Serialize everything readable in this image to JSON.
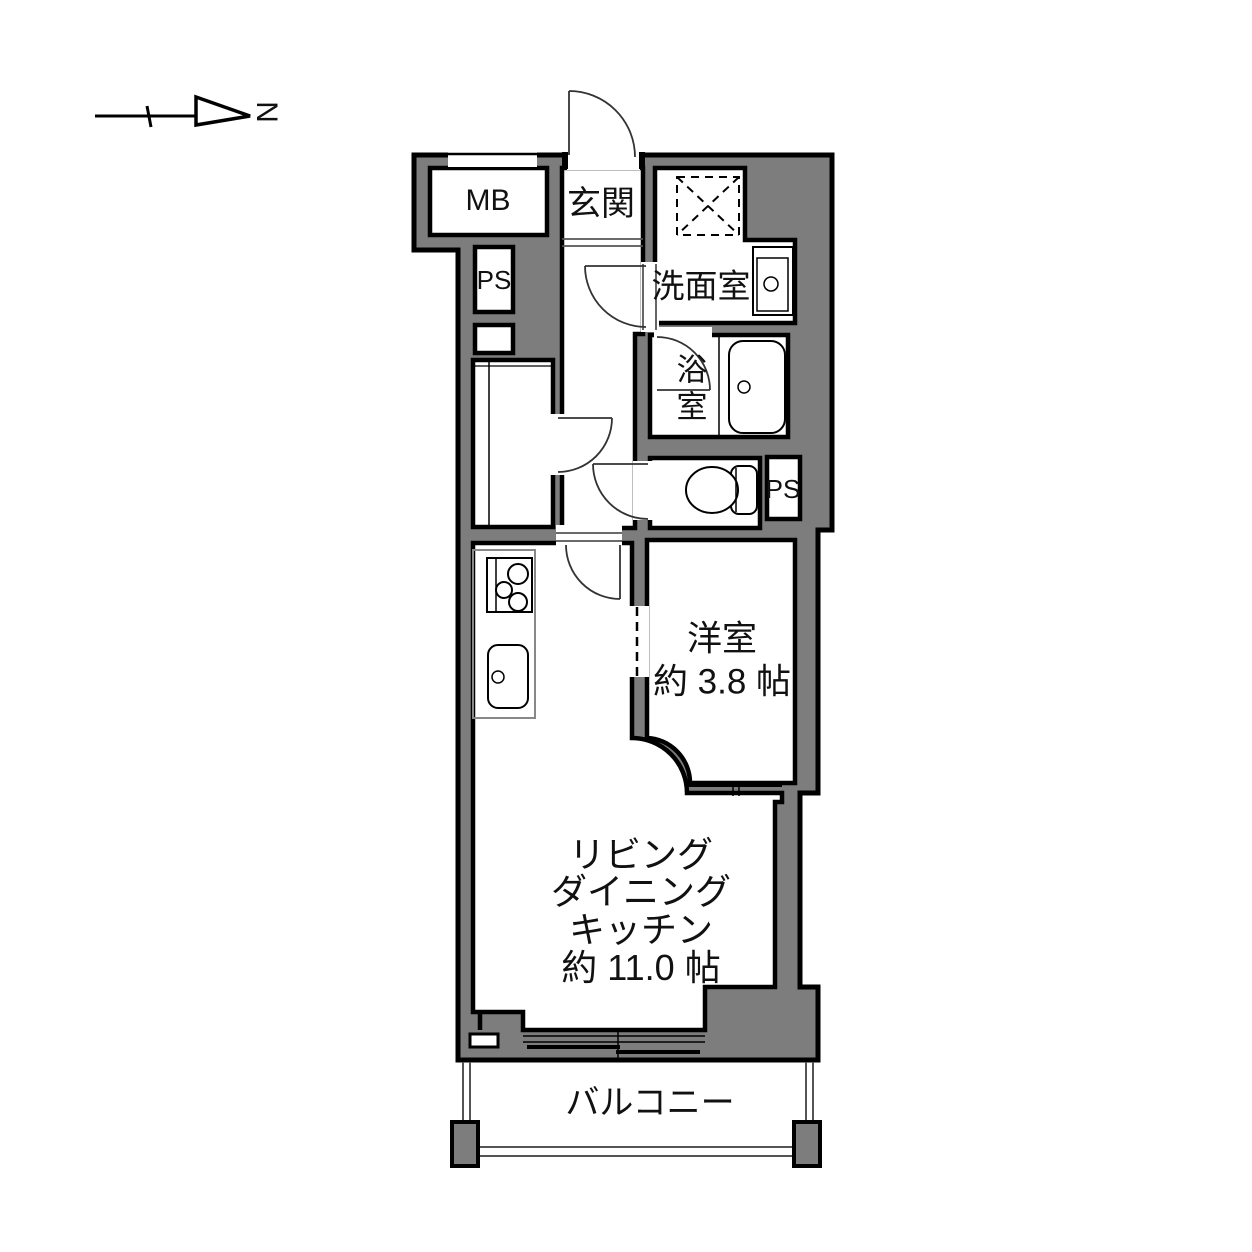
{
  "colors": {
    "wall_fill": "#7d7d7d",
    "wall_stroke": "#000000",
    "floor": "#ffffff",
    "thin_line": "#555555"
  },
  "compass": {
    "label": "N"
  },
  "rooms": {
    "meter_box": {
      "label": "MB"
    },
    "pipe_space_top": {
      "label": "PS"
    },
    "entrance": {
      "label": "玄関"
    },
    "washroom": {
      "label": "洗面室"
    },
    "bathroom": {
      "label": "浴室"
    },
    "pipe_space_right": {
      "label": "PS"
    },
    "western_room": {
      "label": "洋室",
      "area": "約 3.8 帖"
    },
    "ldk": {
      "lines": [
        "リビング",
        "ダイニング",
        "キッチン",
        "約 11.0 帖"
      ]
    },
    "balcony": {
      "label": "バルコニー"
    }
  }
}
